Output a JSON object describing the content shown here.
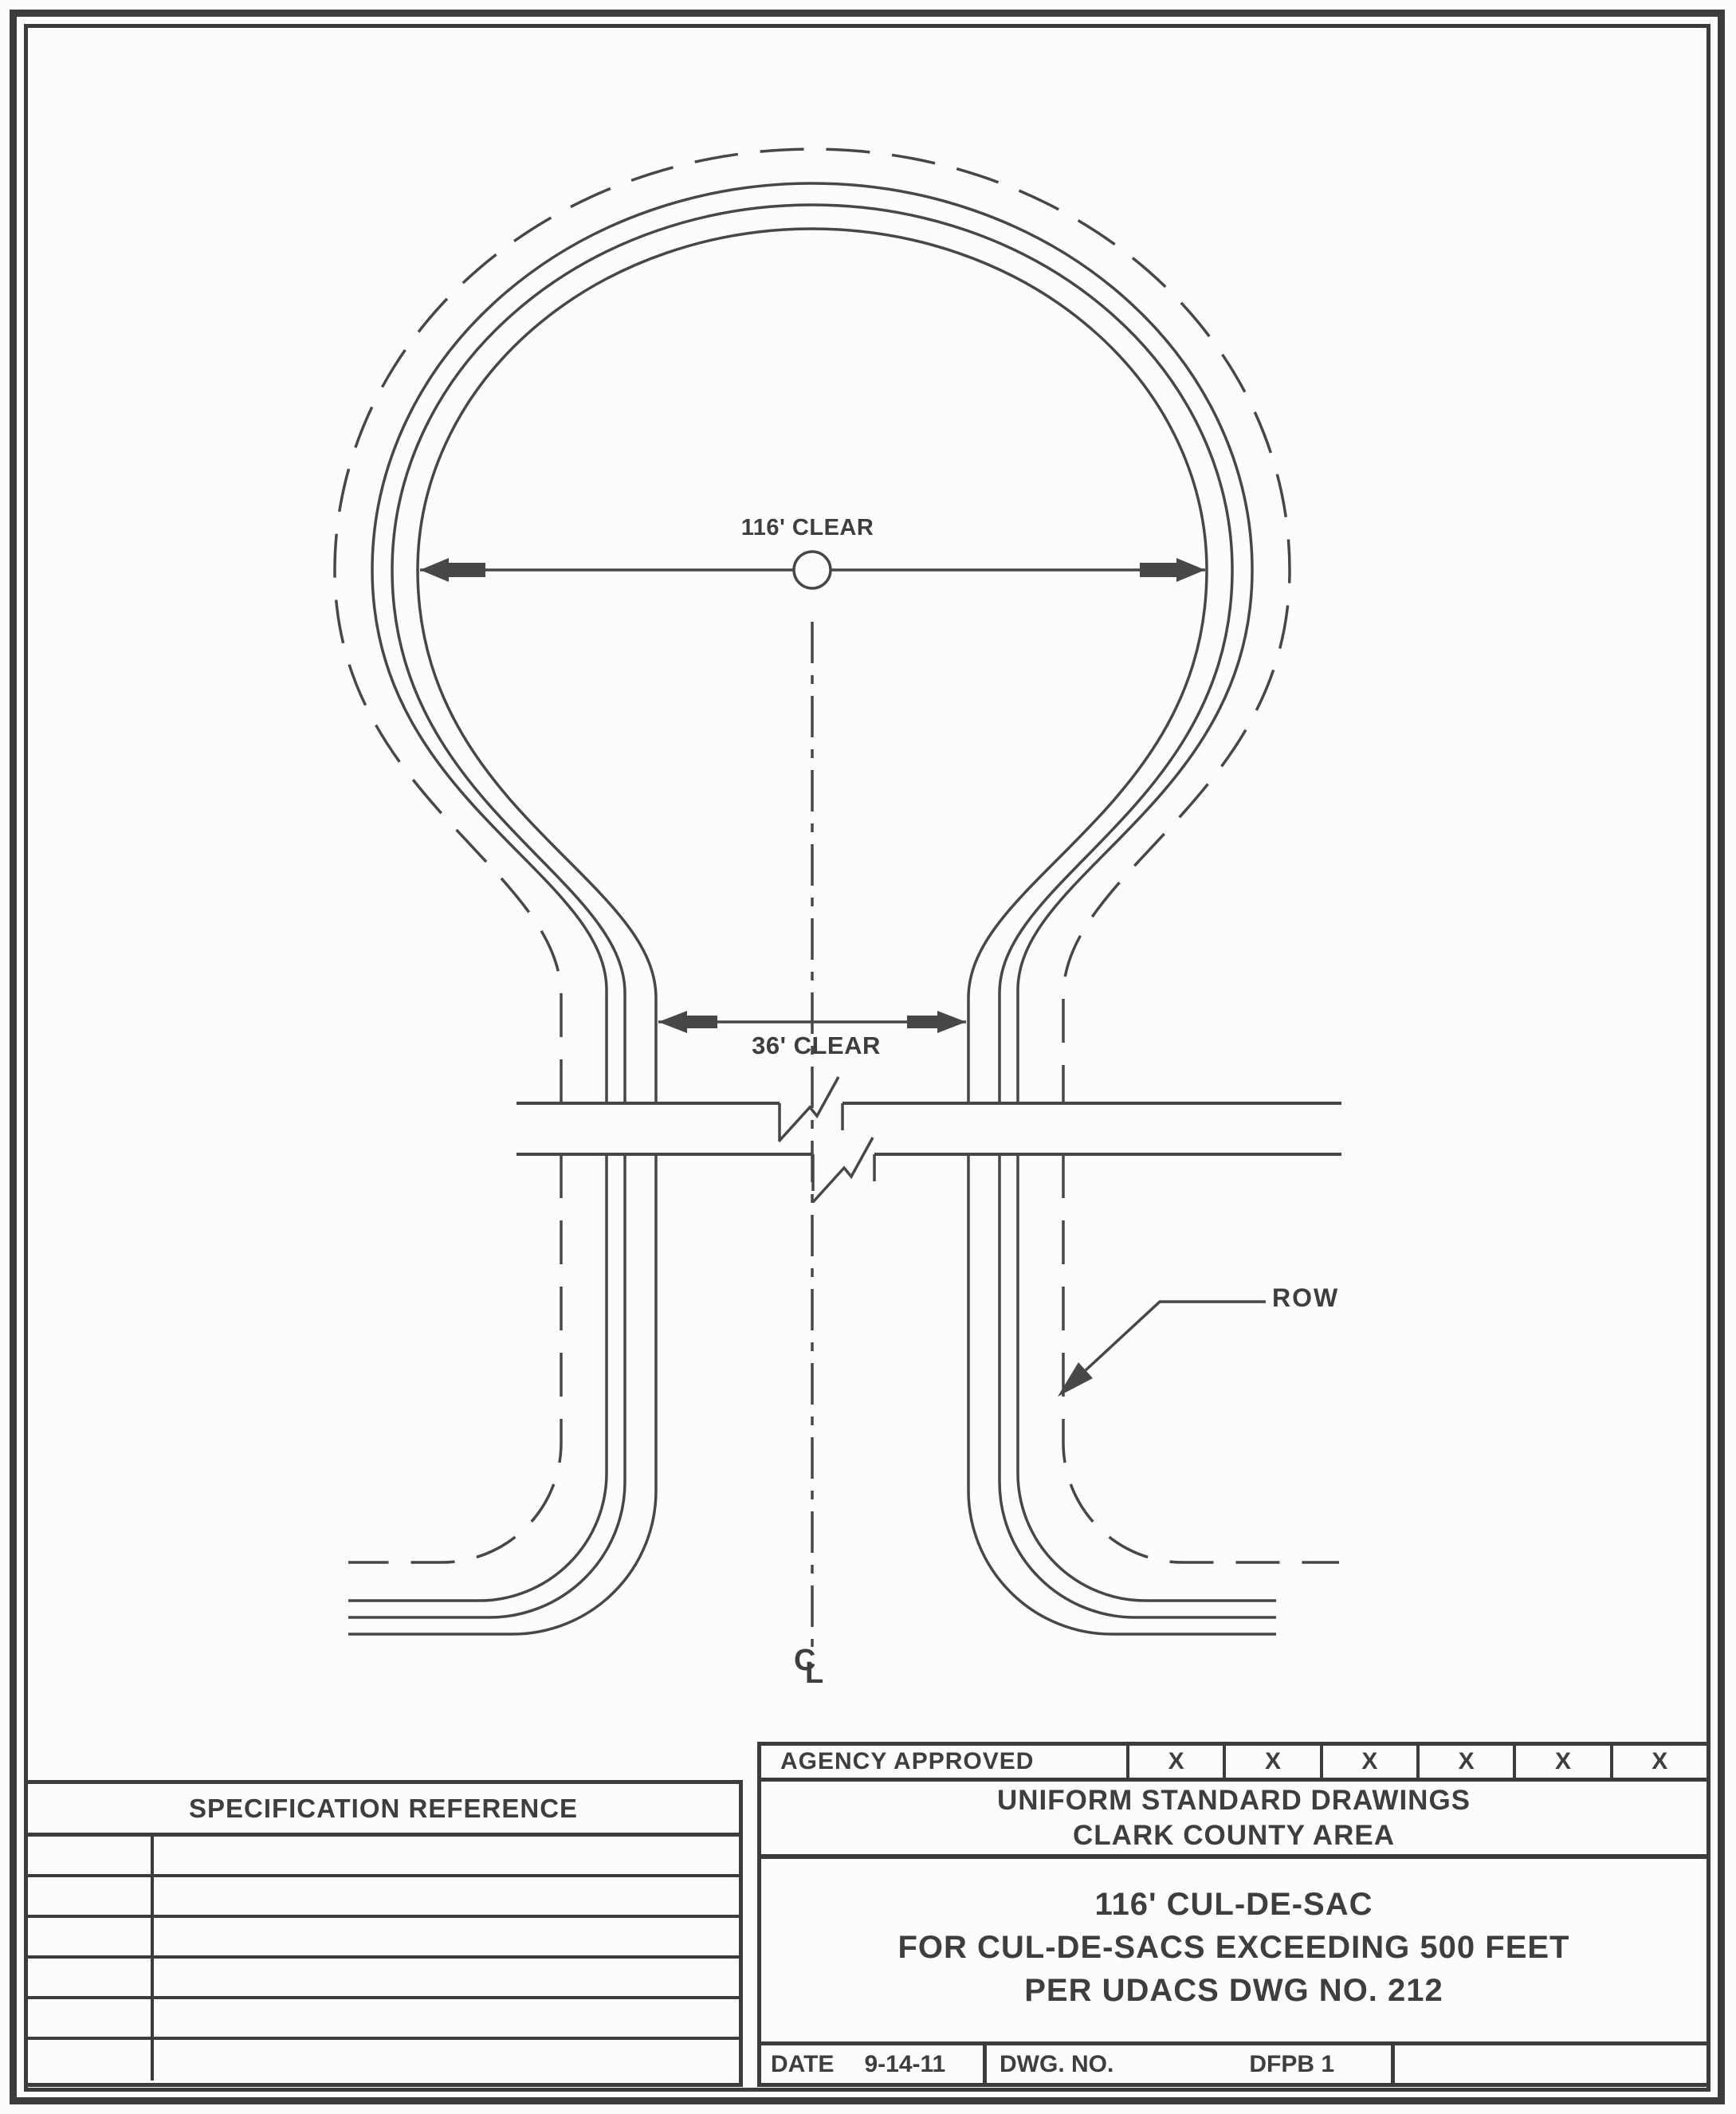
{
  "drawing": {
    "bulb_dimension": "116' CLEAR",
    "street_dimension": "36' CLEAR",
    "row_label": "ROW",
    "centerline_c": "C",
    "centerline_l": "L"
  },
  "title_block": {
    "agency": {
      "label": "AGENCY APPROVED",
      "cells": [
        "X",
        "X",
        "X",
        "X",
        "X",
        "X"
      ]
    },
    "org": {
      "line1": "UNIFORM STANDARD DRAWINGS",
      "line2": "CLARK COUNTY AREA"
    },
    "sheet_title": {
      "line1": "116' CUL-DE-SAC",
      "line2": "FOR CUL-DE-SACS EXCEEDING 500 FEET",
      "line3": "PER UDACS DWG NO. 212"
    },
    "date": {
      "label": "DATE",
      "value": "9-14-11"
    },
    "dwg": {
      "label": "DWG. NO.",
      "value": "DFPB 1"
    },
    "spec": {
      "label": "SPECIFICATION REFERENCE"
    }
  }
}
